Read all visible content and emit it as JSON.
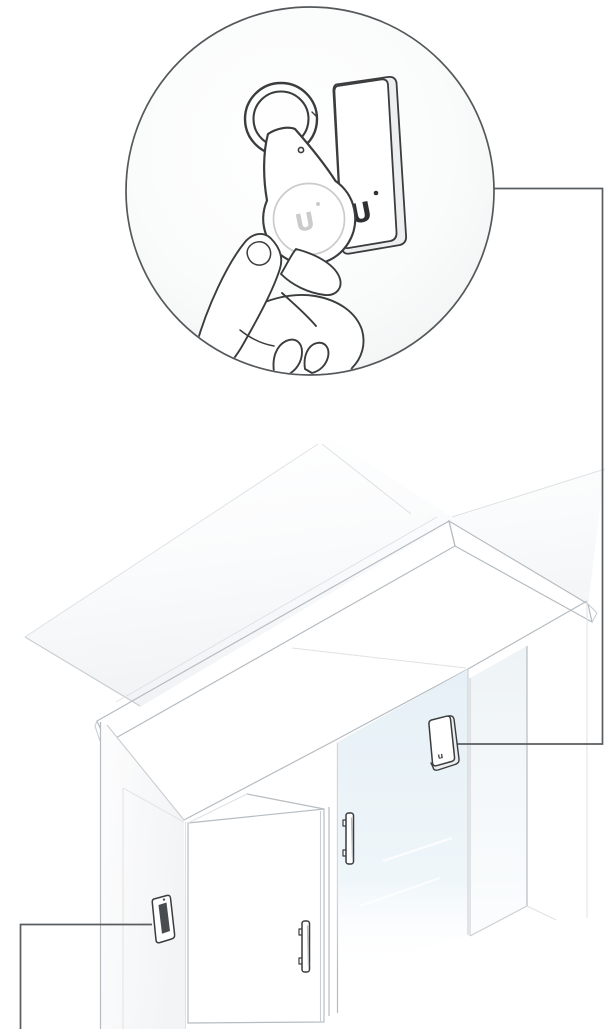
{
  "illustration": {
    "kind": "access-reader installation line illustration",
    "inset": {
      "reader_logo": "U",
      "fob_logo": "U"
    },
    "entrance": {
      "glass_reader_mark": "u"
    }
  },
  "colors": {
    "background": "#ffffff",
    "outline_dark": "#3a3c3e",
    "circle_stroke": "#55585b",
    "callout": "#5a5d60",
    "line_mid": "#b6bcc1",
    "line_light": "#c9ced2",
    "line_faint": "#dfe2e5",
    "roof_shade": "#eff1f3",
    "wall_shade": "#f3f4f5",
    "side_shade": "#eceef0",
    "glass_deep": "#d9e9f2",
    "glass_light": "#f8fbfd",
    "glass_top": "#e6f0f6",
    "panel_tint": "#eef3f6",
    "slot_dark": "#4a4d50",
    "logo_dark": "#2e3032",
    "logo_faint": "#c9cbcd",
    "reflection": "#ffffff"
  }
}
